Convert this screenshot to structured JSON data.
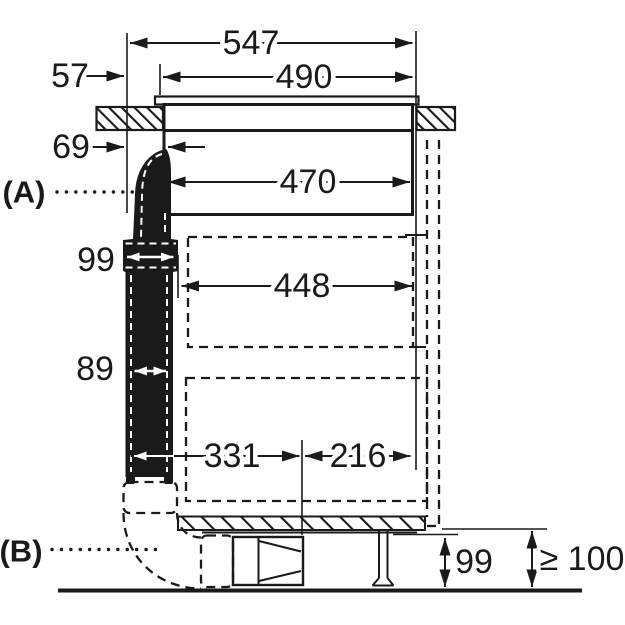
{
  "dims": {
    "top_total": "547",
    "top_cutout": "490",
    "left_overhang": "57",
    "left_gap": "69",
    "hob_inner": "470",
    "recess_width": "448",
    "duct_connector": "99",
    "duct_depth": "89",
    "bottom_left_span": "331",
    "bottom_right_span": "216",
    "plinth_recess_height": "99",
    "min_floor_clearance": "≥ 100"
  },
  "callouts": {
    "a": "(A)",
    "b": "(B)"
  },
  "colors": {
    "ink": "#1a1a1a",
    "background": "#ffffff"
  }
}
